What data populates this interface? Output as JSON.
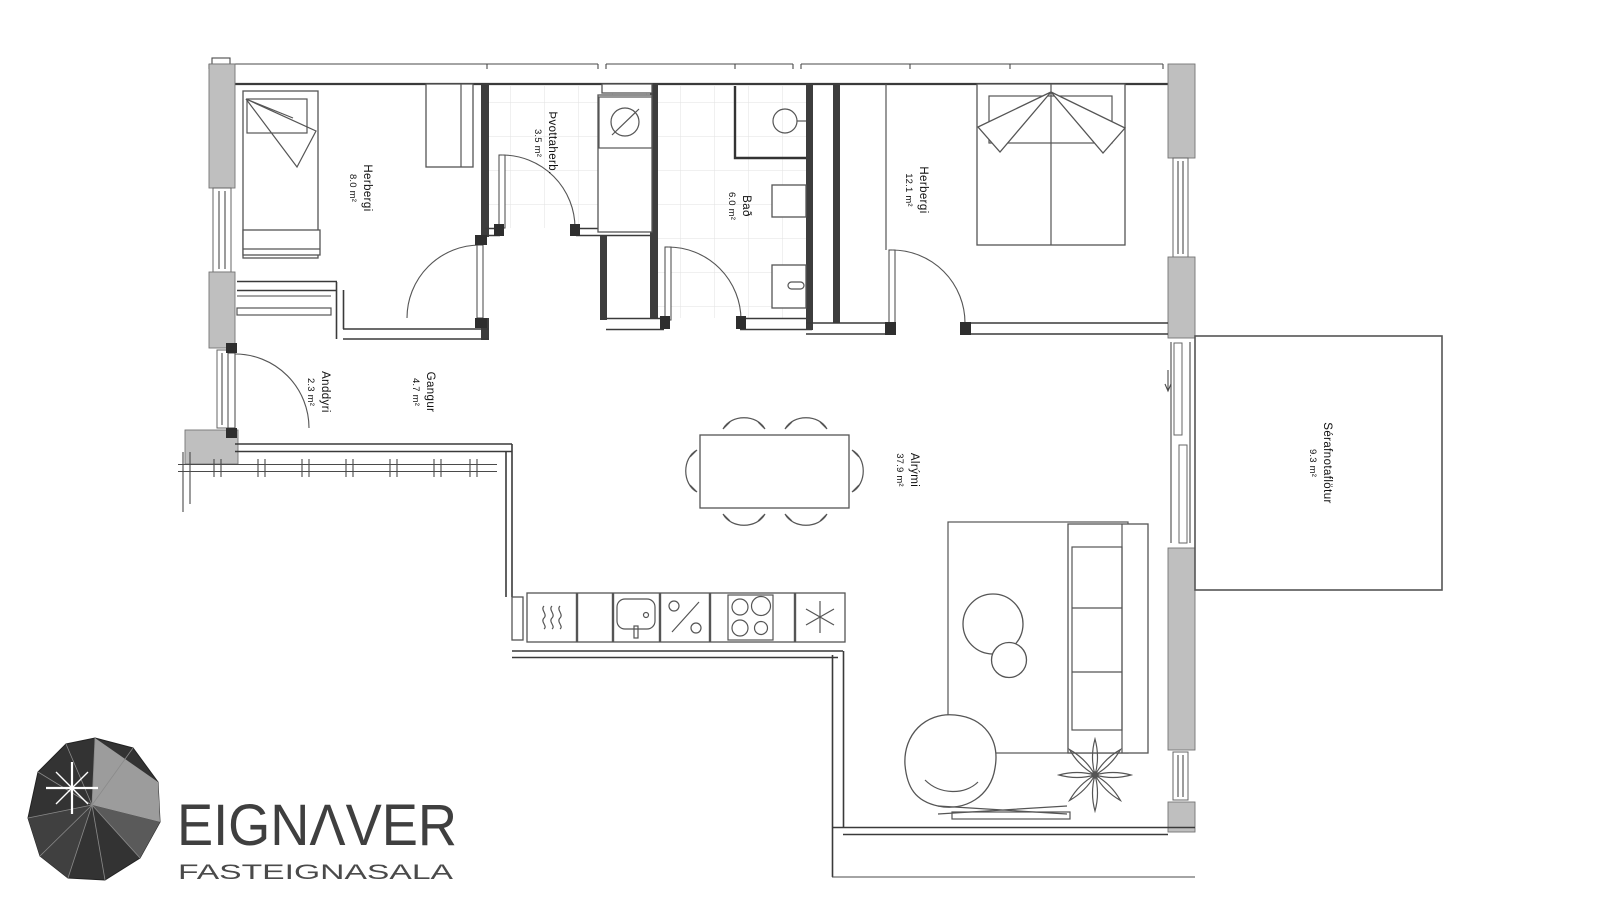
{
  "floorplan": {
    "rooms": [
      {
        "id": "herbergi-1",
        "name": "Herbergi",
        "area": "8.0 m²"
      },
      {
        "id": "thvottaherb",
        "name": "Þvottaherb.",
        "area": "3.5 m²"
      },
      {
        "id": "bad",
        "name": "Bað",
        "area": "6.0 m²"
      },
      {
        "id": "herbergi-2",
        "name": "Herbergi",
        "area": "12.1 m²"
      },
      {
        "id": "anddyri",
        "name": "Anddyri",
        "area": "2.3 m²"
      },
      {
        "id": "gangur",
        "name": "Gangur",
        "area": "4.7 m²"
      },
      {
        "id": "alrymi",
        "name": "Alrými",
        "area": "37.9 m²"
      },
      {
        "id": "serafnotaflotur",
        "name": "Sérafnotaflötur",
        "area": "9.3 m²"
      }
    ],
    "colors": {
      "background": "#ffffff",
      "wall_fill": "#bfbfbf",
      "line": "#3a3a3a",
      "tile_line": "#e2e2e2",
      "logo_text": "#3f3f3f"
    },
    "furniture_icons": [
      "single-bed-icon",
      "double-bed-icon",
      "wardrobe-icon",
      "desk-icon",
      "washing-machine-icon",
      "laundry-counter-icon",
      "bath-sink-icon",
      "toilet-icon",
      "dining-table-icon",
      "dining-chair-icon",
      "oven-icon",
      "kitchen-sink-icon",
      "dishwasher-icon",
      "cooktop-icon",
      "freezer-icon",
      "sofa-icon",
      "rug-icon",
      "coffee-table-icon",
      "armchair-icon",
      "tv-icon",
      "plant-icon"
    ]
  },
  "logo": {
    "name": "EIGNΛVER",
    "tagline": "FASTEIGNASALA"
  }
}
